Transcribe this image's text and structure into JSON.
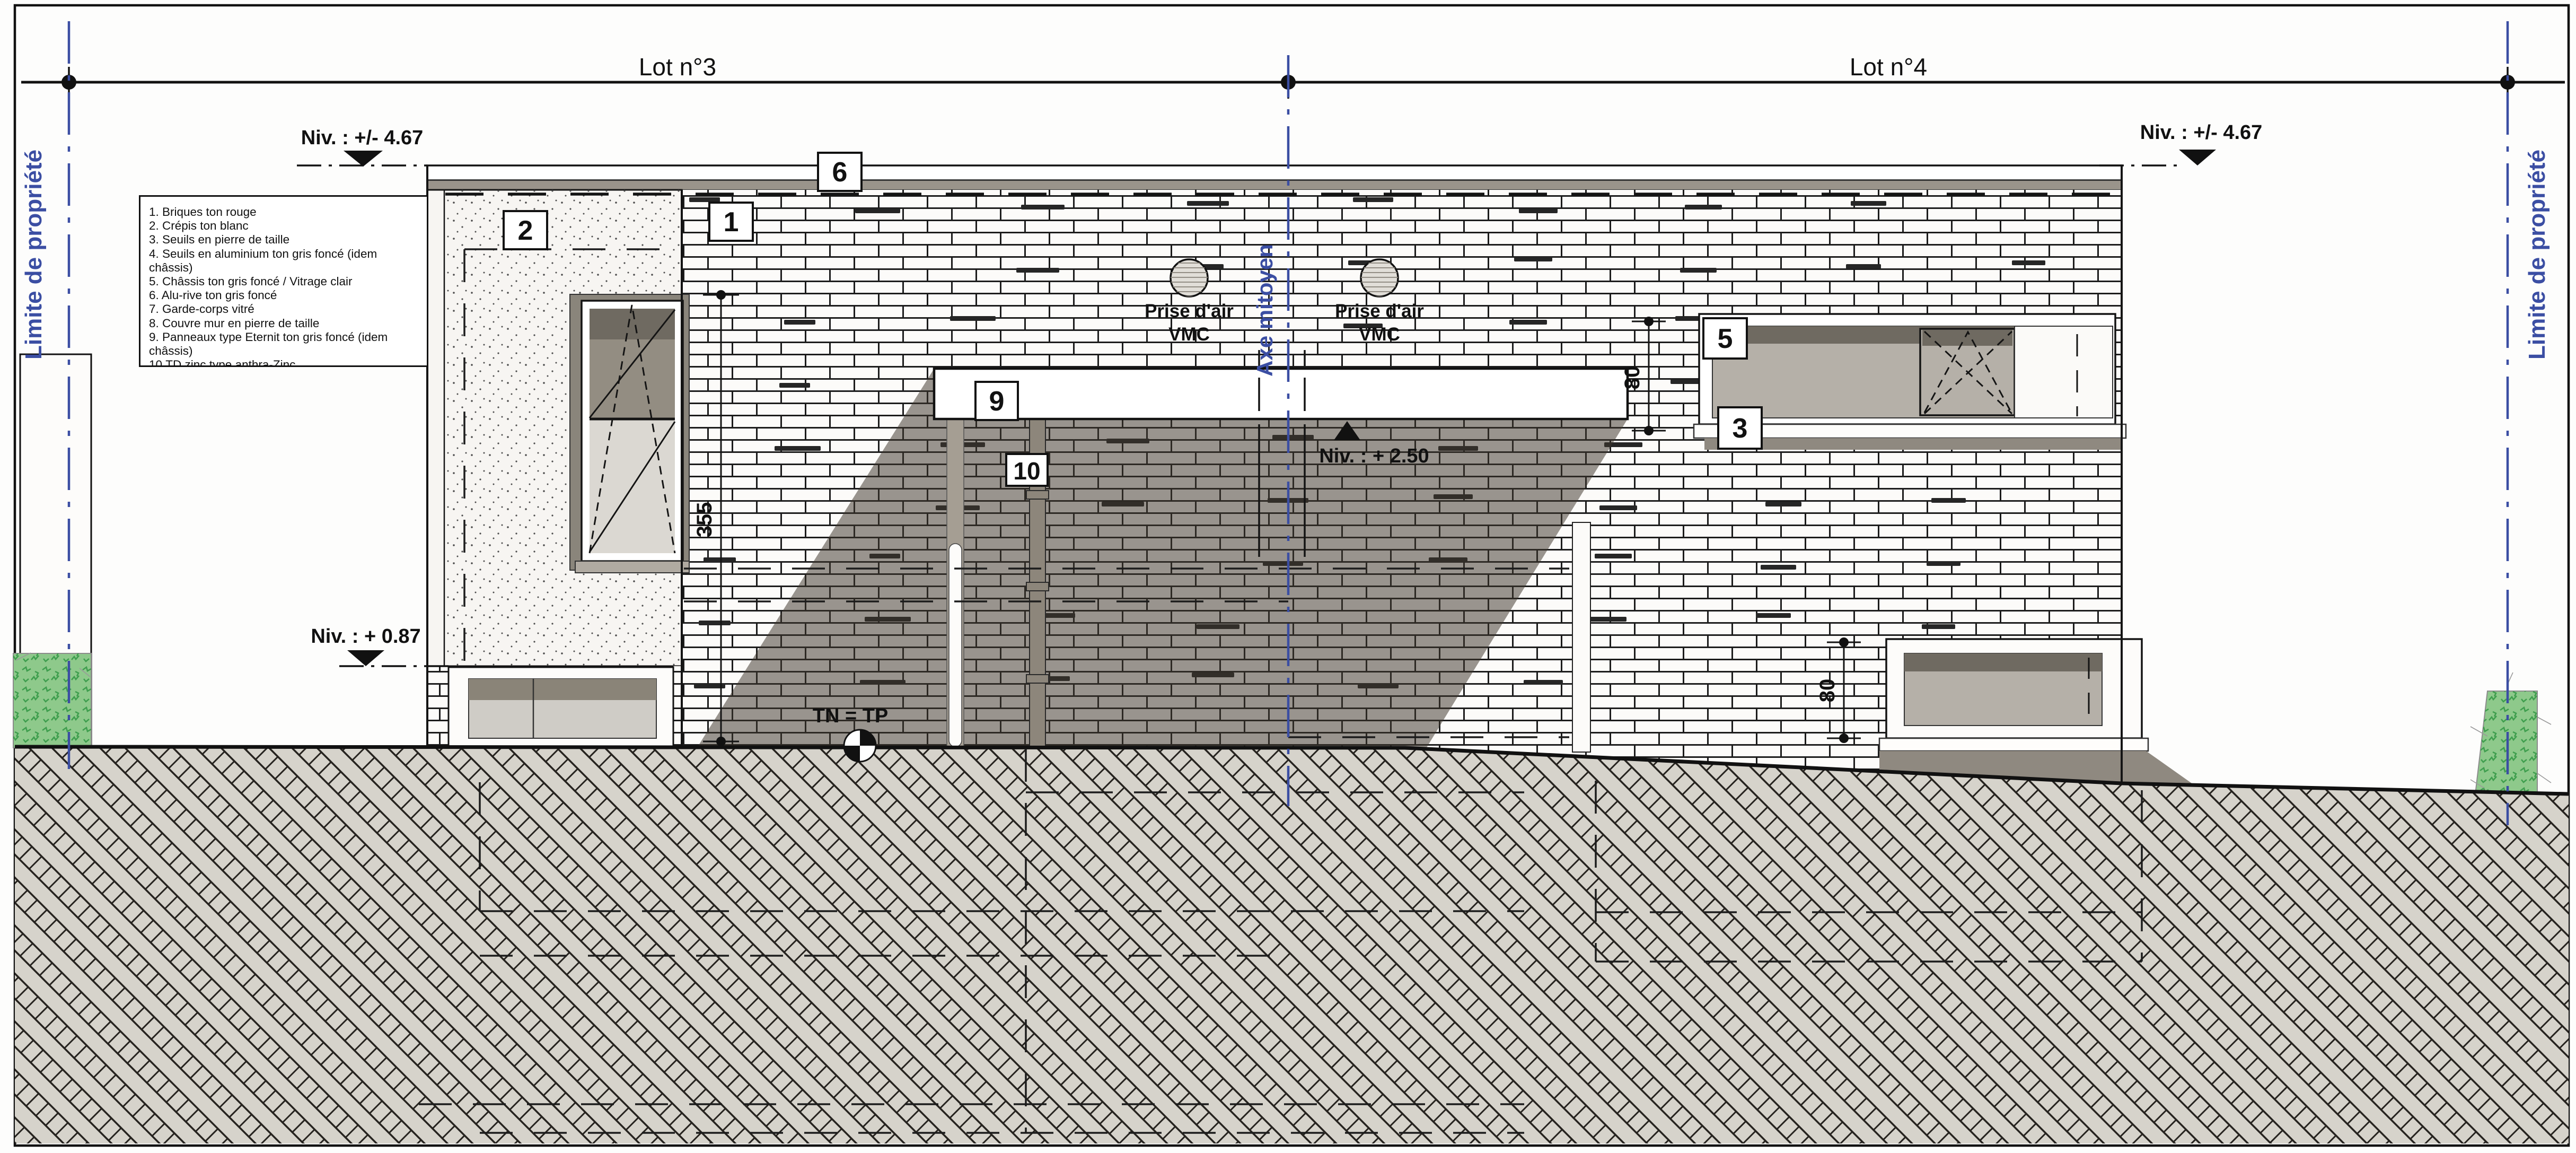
{
  "sheet": {
    "lots": [
      "Lot n°3",
      "Lot n°4"
    ],
    "boundary_label": "Limite de propriété",
    "axis_label": "Axe mitoyen"
  },
  "levels": {
    "roof": "Niv. : +/- 4.67",
    "canopy": "Niv. : + 2.50",
    "floor": "Niv. : + 0.87",
    "ground": "TN = TP"
  },
  "dimensions": {
    "storey": "355",
    "window_upper": "80",
    "window_lower": "80"
  },
  "markers": {
    "m1": "1",
    "m2": "2",
    "m3": "3",
    "m5": "5",
    "m6": "6",
    "m9": "9",
    "m10": "10"
  },
  "vmc": {
    "line1": "Prise d'air",
    "line2": "VMC"
  },
  "legend": {
    "items": [
      "1. Briques ton rouge",
      "2. Crépis ton blanc",
      "3. Seuils en pierre de taille",
      "4. Seuils en aluminium ton gris foncé (idem châssis)",
      "5. Châssis ton gris foncé / Vitrage clair",
      "6. Alu-rive ton gris foncé",
      "7. Garde-corps vitré",
      "8. Couvre mur en pierre de taille",
      "9. Panneaux type Eternit ton gris foncé (idem châssis)",
      "10.TD zinc type anthra-Zinc",
      "11.Terrasse Structure acier ton gris foncé (idem châssis) plancher bois ton naturel"
    ]
  },
  "colors": {
    "boundary_blue": "#3b4ea3",
    "shadow": "rgba(62,54,45,0.52)",
    "brick_joint": "#1c1c1c",
    "earth_fill": "#d6d3cb",
    "glazing": "#b5b0a8",
    "glazing_dark": "#6f6a61",
    "coping_gray": "#9a948b",
    "bush_green": "#8ec98b",
    "bush_line": "#3f9e4e"
  }
}
